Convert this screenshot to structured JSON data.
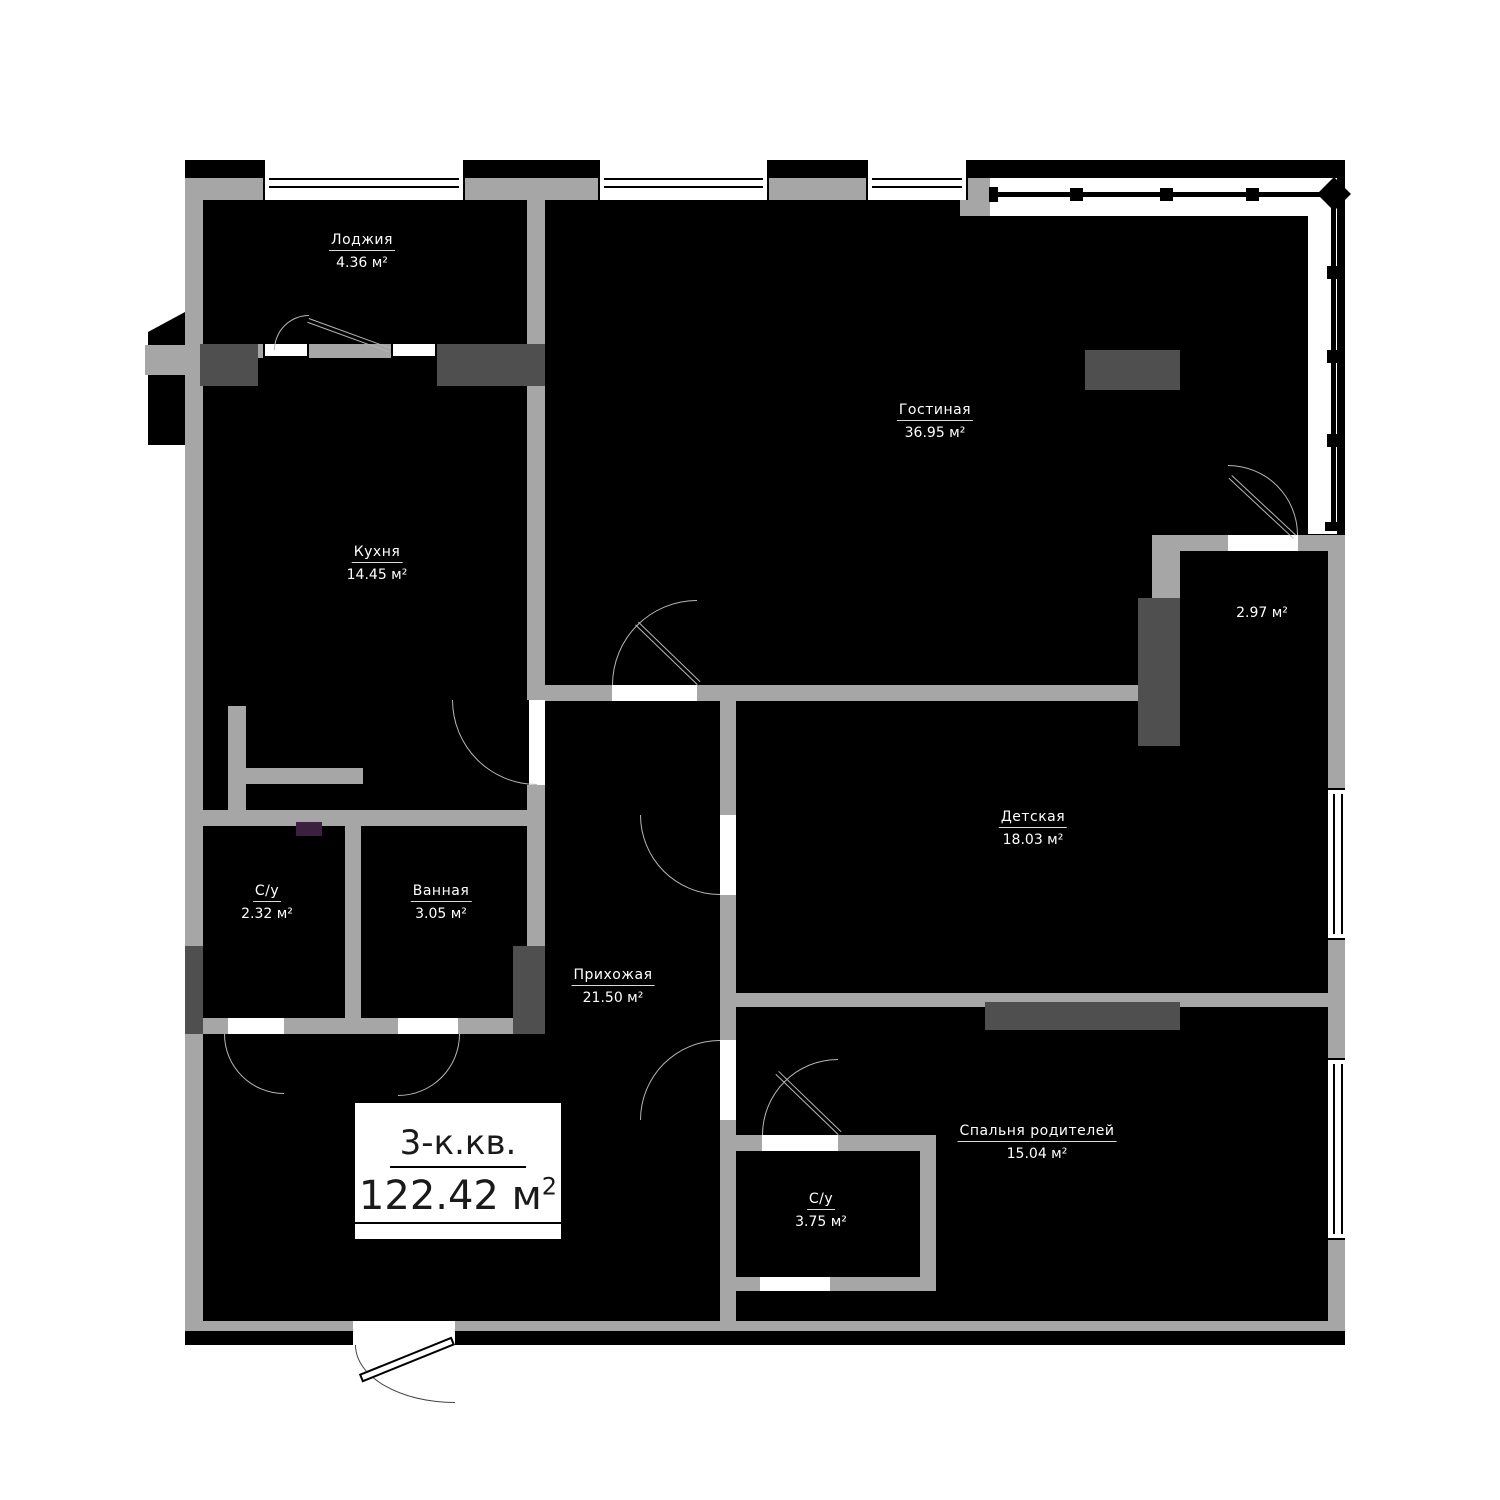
{
  "plan_title": {
    "type": "3-к.кв.",
    "area_value": "122.42",
    "area_unit": "м",
    "area_sup": "2"
  },
  "rooms": [
    {
      "name": "Лоджия",
      "area": "4.36 м²"
    },
    {
      "name": "Кухня",
      "area": "14.45 м²"
    },
    {
      "name": "Гостиная",
      "area": "36.95 м²"
    },
    {
      "name": "",
      "area": "2.97 м²"
    },
    {
      "name": "Детская",
      "area": "18.03 м²"
    },
    {
      "name": "С/у",
      "area": "2.32 м²"
    },
    {
      "name": "Ванная",
      "area": "3.05 м²"
    },
    {
      "name": "Прихожая",
      "area": "21.50 м²"
    },
    {
      "name": "Спальня родителей",
      "area": "15.04 м²"
    },
    {
      "name": "С/у",
      "area": "3.75 м²"
    }
  ],
  "colors": {
    "background": "#ffffff",
    "room_fill": "#000000",
    "wall": "#a6a6a6",
    "wall_dark": "#4f4f4f",
    "accent_purple": "#3c2040",
    "label_text": "#ffffff",
    "title_text": "#1a1a1a"
  }
}
